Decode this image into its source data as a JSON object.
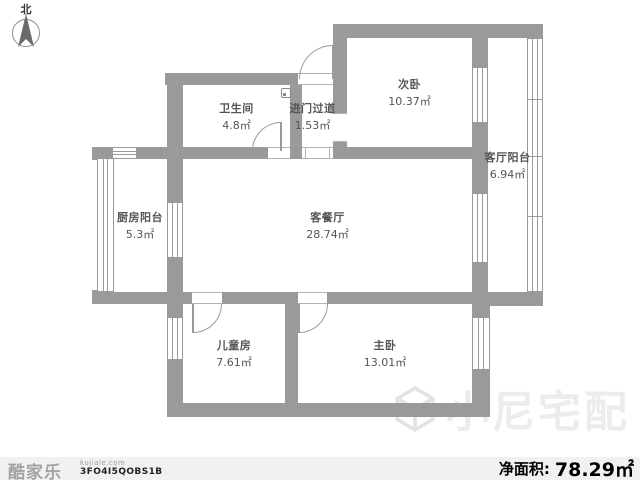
{
  "compass": {
    "north_label": "北"
  },
  "rooms": [
    {
      "id": "bathroom",
      "name": "卫生间",
      "area": "4.8㎡"
    },
    {
      "id": "entry-corridor",
      "name": "进门过道",
      "area": "1.53㎡"
    },
    {
      "id": "secondary-bedroom",
      "name": "次卧",
      "area": "10.37㎡"
    },
    {
      "id": "living-balcony",
      "name": "客厅阳台",
      "area": "6.94㎡"
    },
    {
      "id": "kitchen-balcony",
      "name": "厨房阳台",
      "area": "5.3㎡"
    },
    {
      "id": "living-dining",
      "name": "客餐厅",
      "area": "28.74㎡"
    },
    {
      "id": "kids-room",
      "name": "儿童房",
      "area": "7.61㎡"
    },
    {
      "id": "master-bedroom",
      "name": "主卧",
      "area": "13.01㎡"
    }
  ],
  "watermark": {
    "text": "小尼宅配"
  },
  "footer": {
    "brand": "酷家乐",
    "brand_site": "kujiale.com",
    "plan_code": "3FO4I5QOBS1B",
    "net_area_label": "净面积:",
    "net_area_value": "78.29㎡"
  },
  "colors": {
    "wall": "#9a9a9a",
    "room_label": "#555555",
    "footer_bg": "#f1f1f1",
    "watermark": "#ececec"
  }
}
